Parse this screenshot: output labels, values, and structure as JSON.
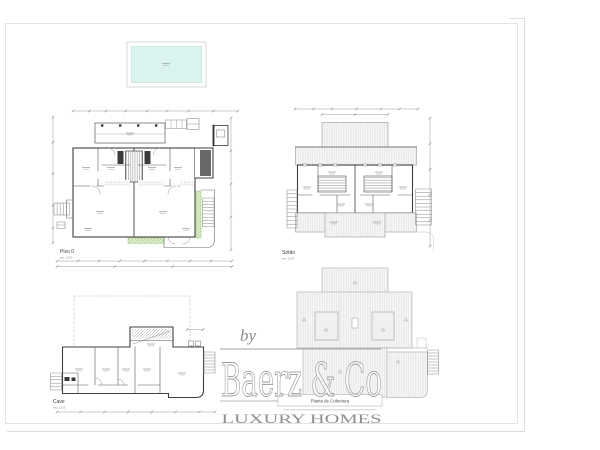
{
  "plans": {
    "piso0": {
      "title": "Piso 0",
      "scale_note": "esc: 1/100"
    },
    "sotao": {
      "title": "Sótão",
      "scale_note": "esc: 1/100"
    },
    "cave": {
      "title": "Cave",
      "scale_note": "esc: 1/100"
    },
    "cobertura": {
      "title": "Planta de Cobertura"
    }
  },
  "watermark": {
    "prefix": "by",
    "brand": "Baerz & Co",
    "tagline": "LUXURY HOMES"
  },
  "colors": {
    "pool_water": "#daf3ee",
    "roof_hatch": "#f6f6f6",
    "planter_green": "#86b85e",
    "wall_ink": "#3f3f3f",
    "dim_ink": "#9b9b9b",
    "watermark_gray": "#9a9a9a"
  }
}
